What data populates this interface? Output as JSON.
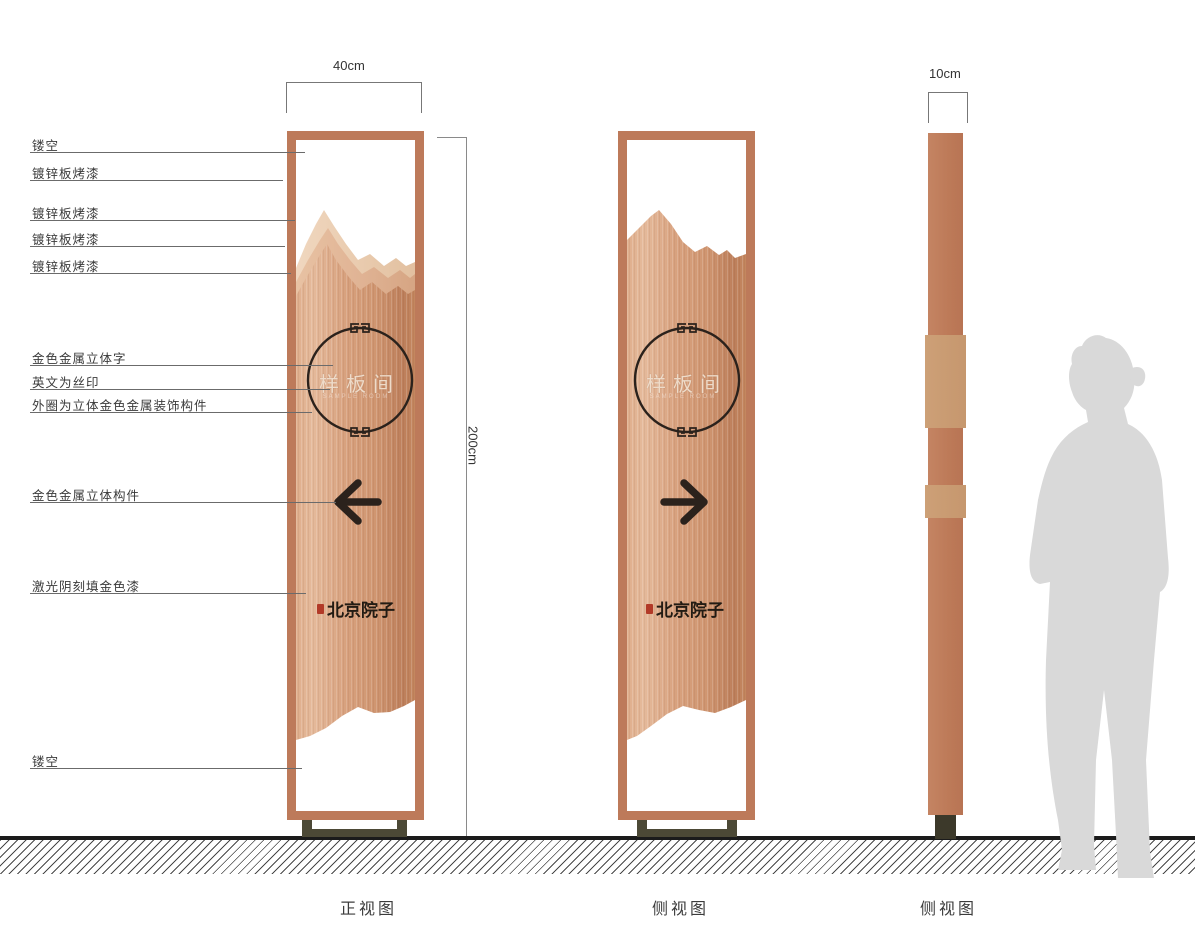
{
  "dimensions": {
    "front_width": "40cm",
    "total_height": "200cm",
    "side_depth": "10cm"
  },
  "callouts": [
    {
      "label": "镂空"
    },
    {
      "label": "镀锌板烤漆"
    },
    {
      "label": "镀锌板烤漆"
    },
    {
      "label": "镀锌板烤漆"
    },
    {
      "label": "镀锌板烤漆"
    },
    {
      "label": "金色金属立体字"
    },
    {
      "label": "英文为丝印"
    },
    {
      "label": "外圈为立体金色金属装饰构件"
    },
    {
      "label": "金色金属立体构件"
    },
    {
      "label": "激光阴刻填金色漆"
    },
    {
      "label": "镂空"
    }
  ],
  "sign": {
    "circle_text": "样板间",
    "english_subtext": "SAMPLE ROOM",
    "brand_text": "北京院子"
  },
  "views": [
    {
      "name": "正视图"
    },
    {
      "name": "侧视图"
    },
    {
      "name": "侧视图"
    }
  ],
  "colors": {
    "frame_copper": "#bd7a5a",
    "panel_copper_mid": "#d8a17e",
    "panel_copper_dark": "#bd7f5b",
    "mountain_light": "#e9cbae",
    "mountain_mid": "#e0b394",
    "ink_dark": "#2b221c",
    "seal_red": "#b23a28",
    "base_olive": "#4c4936",
    "silhouette_gray": "#d9d9d9",
    "ground_black": "#1b1b1b"
  }
}
